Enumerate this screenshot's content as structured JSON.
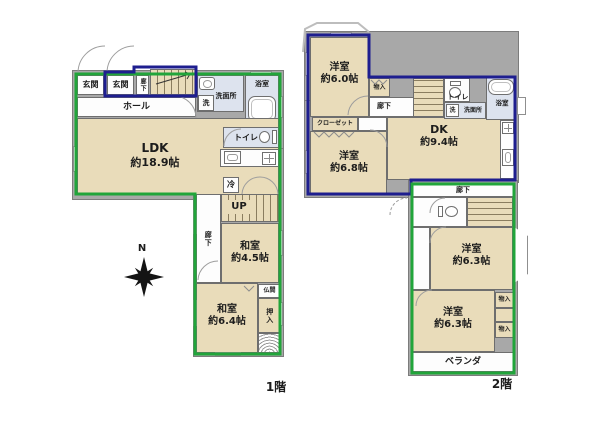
{
  "page": {
    "floor1_label": "1階",
    "floor2_label": "2階",
    "compass_north": "N"
  },
  "floor1": {
    "genkan_left": "玄関",
    "genkan_right": "玄関",
    "entry_corridor": "廊下",
    "hall": "ホール",
    "washroom": "洗面所",
    "washer": "洗",
    "bathroom": "浴室",
    "ldk_name": "LDK",
    "ldk_size": "約18.9帖",
    "toilet": "トイレ",
    "fridge": "冷",
    "stairs_up": "UP",
    "corridor": "廊下",
    "washitsu_45_name": "和室",
    "washitsu_45_size": "約4.5帖",
    "washitsu_64_name": "和室",
    "washitsu_64_size": "約6.4帖",
    "butsuma": "仏間",
    "oshiire": "押入"
  },
  "floor2": {
    "yoshitsu_60_name": "洋室",
    "yoshitsu_60_size": "約6.0帖",
    "monoire_top": "物入",
    "closet": "クローゼット",
    "yoshitsu_68_name": "洋室",
    "yoshitsu_68_size": "約6.8帖",
    "corridor_upper": "廊下",
    "toilet_upper": "トイレ",
    "washer": "洗",
    "washroom": "洗面所",
    "bathroom": "浴室",
    "dk_name": "DK",
    "dk_size": "約9.4帖",
    "corridor_lower": "廊下",
    "yoshitsu_63_upper_name": "洋室",
    "yoshitsu_63_upper_size": "約6.3帖",
    "yoshitsu_63_lower_name": "洋室",
    "yoshitsu_63_lower_size": "約6.3帖",
    "monoire_a": "物入",
    "monoire_b": "物入",
    "veranda": "ベランダ"
  },
  "colors": {
    "unit_outline_green": "#21a53a",
    "unit_outline_navy": "#1e1e8f",
    "tatami_beige": "#e9dcba",
    "wet_area_blue": "#dde3ee",
    "wall_gray": "#a8a8a8"
  }
}
